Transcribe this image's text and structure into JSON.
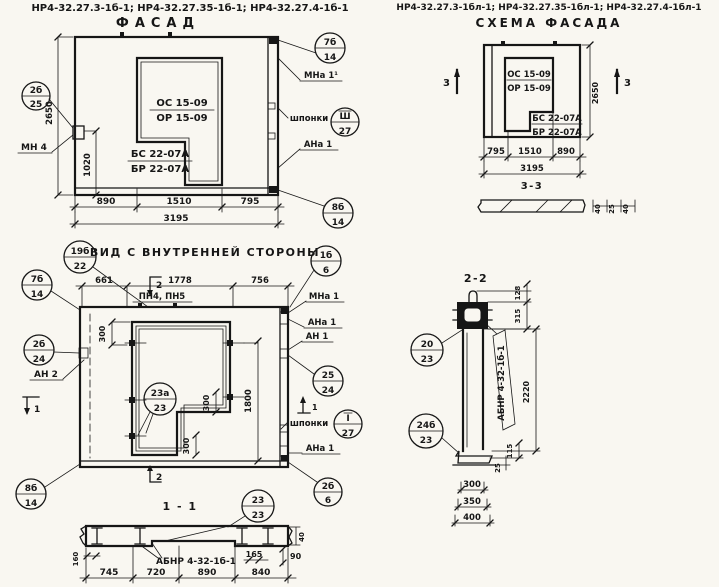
{
  "headers": {
    "left_codes": "НР4-32.27.3-1б-1; НР4-32.27.35-1б-1; НР4-32.27.4-1б-1",
    "left_title": "ФАСАД",
    "right_codes": "НР4-32.27.3-1бл-1; НР4-32.27.35-1бл-1; НР4-32.27.4-1бл-1",
    "right_title": "СХЕМА ФАСАДА"
  },
  "facade": {
    "win_num": "ОС 15-09",
    "win_den": "ОР 15-09",
    "door_num": "БС 22-07А",
    "door_den": "БР 22-07А",
    "d2650": "2650",
    "d1020": "1020",
    "d890": "890",
    "d1510": "1510",
    "d795": "795",
    "d3195": "3195",
    "mn4": "МН 4",
    "mna1": "МНа 1¹",
    "shponki": "шпонки",
    "ana1": "АНа 1",
    "c1n": "2б",
    "c1d": "25",
    "c2n": "7б",
    "c2d": "14",
    "c3n": "Ш",
    "c3d": "27",
    "c4n": "8б",
    "c4d": "14"
  },
  "inner": {
    "title": "ВИД С ВНУТРЕННЕЙ СТОРОНЫ",
    "d661": "661",
    "d1778": "1778",
    "d756": "756",
    "pn": "ПН4, ПН5",
    "mna1": "МНа 1",
    "ana1a": "АНа 1",
    "an1": "АН 1",
    "shponki": "шпонки",
    "ana1b": "АНа 1",
    "an2": "АН 2",
    "d300a": "300",
    "d300b": "300",
    "d300c": "300",
    "d1800": "1800",
    "f1": "1",
    "f2": "2",
    "c19n": "19б",
    "c19d": "22",
    "c1bn": "1б",
    "c1bd": "6",
    "c7n": "7б",
    "c7d": "14",
    "c2bn": "2б",
    "c2bd": "24",
    "c25n": "25",
    "c25d": "24",
    "cIn": "I",
    "cId": "27",
    "c8n": "8б",
    "c8d": "14",
    "c26n": "2б",
    "c26d": "6",
    "c23n": "23а",
    "c23d": "23"
  },
  "s11": {
    "title": "1 - 1",
    "label": "АБНР 4-32-1б-1",
    "d160": "160",
    "d165": "165",
    "d90": "90",
    "d40": "40",
    "d745": "745",
    "d720": "720",
    "d890": "890",
    "d840": "840",
    "cn": "23",
    "cd": "23"
  },
  "schema": {
    "win_num": "ОС 15-09",
    "win_den": "ОР 15-09",
    "door_num": "БС 22-07А",
    "door_den": "БР 22-07А",
    "d2650": "2650",
    "d795": "795",
    "d1510": "1510",
    "d890": "890",
    "d3195": "3195",
    "f3": "3",
    "sec_title": "3-3",
    "p1": "40",
    "p2": "25",
    "p3": "40"
  },
  "s22": {
    "title": "2-2",
    "label": "АБНР 4-32-1б-1",
    "d128": "128",
    "d315": "315",
    "d2220": "2220",
    "d115": "115",
    "d25": "25",
    "d300": "300",
    "d350": "350",
    "d400": "400",
    "c1n": "20",
    "c1d": "23",
    "c2n": "24б",
    "c2d": "23"
  }
}
